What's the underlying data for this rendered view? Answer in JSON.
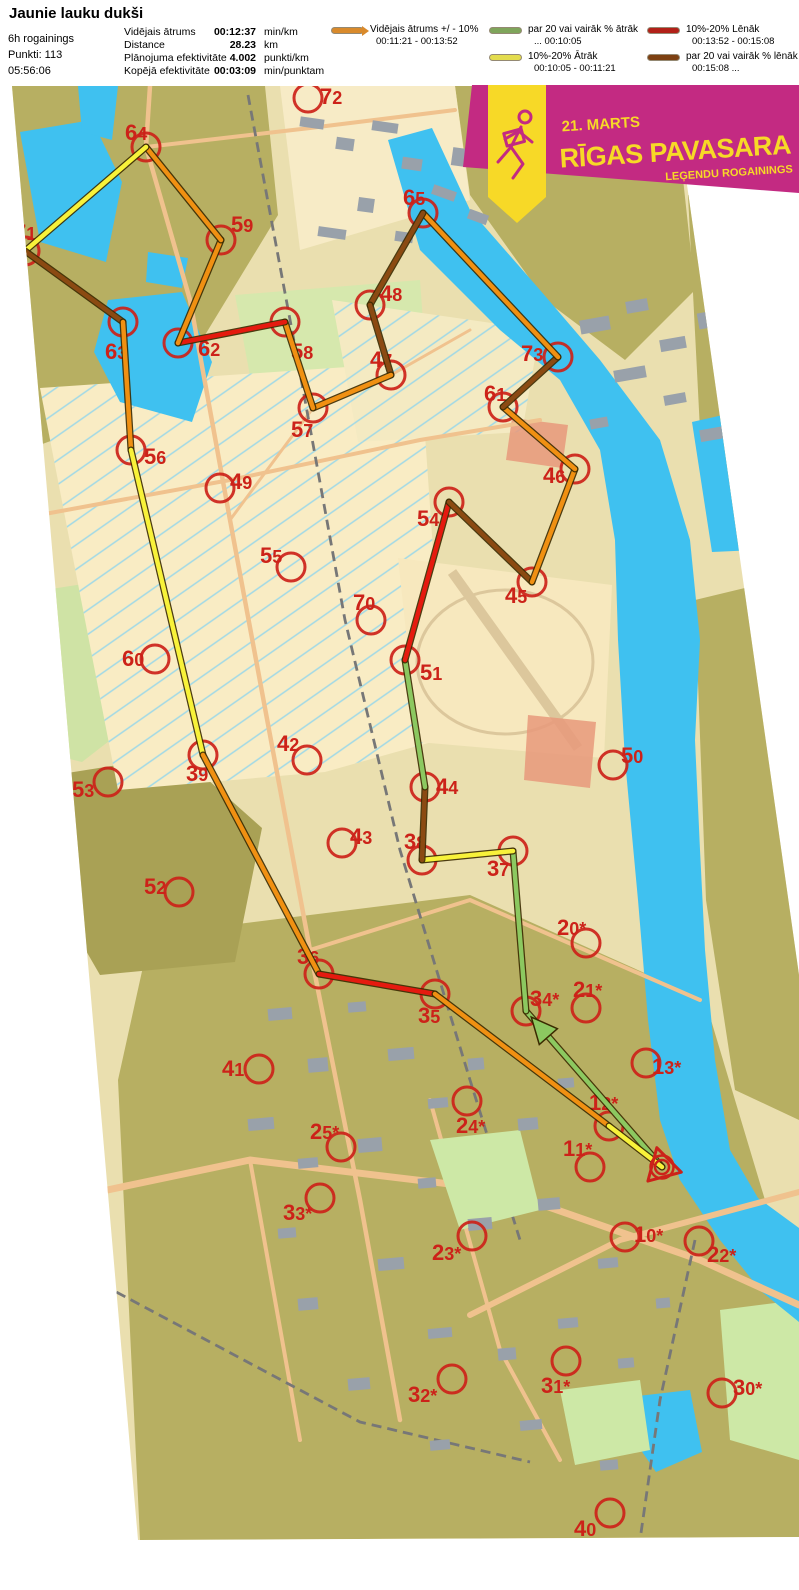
{
  "header": {
    "title": "Jaunie lauku dukši",
    "info_lines": [
      "6h rogainings",
      "Punkti: 113",
      "05:56:06"
    ],
    "stats": [
      {
        "label": "Vidējais ātrums",
        "value": "00:12:37",
        "unit": "min/km"
      },
      {
        "label": "Distance",
        "value": "28.23",
        "unit": "km"
      },
      {
        "label": "Plānojuma efektivitāte",
        "value": "4.002",
        "unit": "punkti/km"
      },
      {
        "label": "Kopējā efektivitāte",
        "value": "00:03:09",
        "unit": "min/punktam"
      }
    ],
    "legend": [
      {
        "label": "Vidējais ātrums +/ - 10%",
        "range": "00:11:21   -   00:13:52",
        "color": "#D98A2B"
      },
      {
        "label": "par 20 vai vairāk % ātrāk",
        "range": "...   00:10:05",
        "color": "#7FA55B"
      },
      {
        "label": "10%-20% Ātrāk",
        "range": "00:10:05   -   00:11:21",
        "color": "#E3DC4E"
      },
      {
        "label": "10%-20% Lēnāk",
        "range": "00:13:52   -   00:15:08",
        "color": "#B22018"
      },
      {
        "label": "par 20 vai vairāk % lēnāk",
        "range": "00:15:08   ...",
        "color": "#7D4012"
      }
    ]
  },
  "banner": {
    "date": "21. MARTS",
    "title": "RĪGAS PAVASARA",
    "subtitle": "LEĢENDU ROGAININGS",
    "bg": "#C32A82",
    "fg": "#F7D927"
  },
  "map": {
    "route_colors": {
      "avg": "#F09012",
      "fast20": "#8CC860",
      "fast10": "#F8F23A",
      "slow10": "#E51A0F",
      "slow20": "#8B4A12"
    },
    "control_color": "#CC2219",
    "start": {
      "id": "start",
      "x": 662,
      "y": 1167
    },
    "controls": [
      {
        "id": "72",
        "x": 308,
        "y": 98,
        "lx": 320,
        "ly": 86
      },
      {
        "id": "64",
        "x": 146,
        "y": 147,
        "lx": 125,
        "ly": 122
      },
      {
        "id": "71",
        "x": 25,
        "y": 251,
        "lx": 14,
        "ly": 222
      },
      {
        "id": "59",
        "x": 221,
        "y": 240,
        "lx": 231,
        "ly": 214
      },
      {
        "id": "65",
        "x": 423,
        "y": 213,
        "lx": 403,
        "ly": 187
      },
      {
        "id": "58",
        "x": 285,
        "y": 322,
        "lx": 291,
        "ly": 341
      },
      {
        "id": "48",
        "x": 370,
        "y": 305,
        "lx": 380,
        "ly": 283
      },
      {
        "id": "63",
        "x": 123,
        "y": 322,
        "lx": 105,
        "ly": 341
      },
      {
        "id": "62",
        "x": 178,
        "y": 343,
        "lx": 198,
        "ly": 338
      },
      {
        "id": "73",
        "x": 558,
        "y": 357,
        "lx": 521,
        "ly": 343
      },
      {
        "id": "47",
        "x": 391,
        "y": 375,
        "lx": 370,
        "ly": 349
      },
      {
        "id": "61",
        "x": 503,
        "y": 407,
        "lx": 484,
        "ly": 383
      },
      {
        "id": "57",
        "x": 313,
        "y": 408,
        "lx": 291,
        "ly": 419
      },
      {
        "id": "56",
        "x": 131,
        "y": 450,
        "lx": 144,
        "ly": 446
      },
      {
        "id": "46",
        "x": 575,
        "y": 469,
        "lx": 543,
        "ly": 465
      },
      {
        "id": "49",
        "x": 220,
        "y": 488,
        "lx": 230,
        "ly": 471
      },
      {
        "id": "54",
        "x": 449,
        "y": 502,
        "lx": 417,
        "ly": 508
      },
      {
        "id": "55",
        "x": 291,
        "y": 567,
        "lx": 260,
        "ly": 545
      },
      {
        "id": "45",
        "x": 532,
        "y": 582,
        "lx": 505,
        "ly": 585
      },
      {
        "id": "70",
        "x": 371,
        "y": 620,
        "lx": 353,
        "ly": 592
      },
      {
        "id": "51",
        "x": 405,
        "y": 660,
        "lx": 420,
        "ly": 662
      },
      {
        "id": "60",
        "x": 155,
        "y": 659,
        "lx": 122,
        "ly": 648
      },
      {
        "id": "39",
        "x": 203,
        "y": 755,
        "lx": 186,
        "ly": 763
      },
      {
        "id": "42",
        "x": 307,
        "y": 760,
        "lx": 277,
        "ly": 733
      },
      {
        "id": "44",
        "x": 425,
        "y": 787,
        "lx": 436,
        "ly": 776
      },
      {
        "id": "50",
        "x": 613,
        "y": 765,
        "lx": 621,
        "ly": 745
      },
      {
        "id": "53",
        "x": 108,
        "y": 782,
        "lx": 72,
        "ly": 779
      },
      {
        "id": "43",
        "x": 342,
        "y": 843,
        "lx": 350,
        "ly": 826
      },
      {
        "id": "38",
        "x": 422,
        "y": 860,
        "lx": 404,
        "ly": 831
      },
      {
        "id": "37",
        "x": 513,
        "y": 851,
        "lx": 487,
        "ly": 858
      },
      {
        "id": "52",
        "x": 179,
        "y": 892,
        "lx": 144,
        "ly": 876
      },
      {
        "id": "20*",
        "x": 586,
        "y": 943,
        "lx": 557,
        "ly": 917
      },
      {
        "id": "36",
        "x": 319,
        "y": 974,
        "lx": 297,
        "ly": 946
      },
      {
        "id": "35",
        "x": 435,
        "y": 994,
        "lx": 418,
        "ly": 1005
      },
      {
        "id": "34*",
        "x": 526,
        "y": 1011,
        "lx": 530,
        "ly": 988
      },
      {
        "id": "21*",
        "x": 586,
        "y": 1008,
        "lx": 573,
        "ly": 979
      },
      {
        "id": "13*",
        "x": 646,
        "y": 1063,
        "lx": 652,
        "ly": 1056
      },
      {
        "id": "41",
        "x": 259,
        "y": 1069,
        "lx": 222,
        "ly": 1058
      },
      {
        "id": "24*",
        "x": 467,
        "y": 1101,
        "lx": 456,
        "ly": 1115
      },
      {
        "id": "12*",
        "x": 609,
        "y": 1126,
        "lx": 589,
        "ly": 1092
      },
      {
        "id": "25*",
        "x": 341,
        "y": 1147,
        "lx": 310,
        "ly": 1121
      },
      {
        "id": "11*",
        "x": 590,
        "y": 1167,
        "lx": 563,
        "ly": 1138
      },
      {
        "id": "33*",
        "x": 320,
        "y": 1198,
        "lx": 283,
        "ly": 1202
      },
      {
        "id": "23*",
        "x": 472,
        "y": 1236,
        "lx": 432,
        "ly": 1242
      },
      {
        "id": "10*",
        "x": 625,
        "y": 1237,
        "lx": 634,
        "ly": 1224
      },
      {
        "id": "22*",
        "x": 699,
        "y": 1241,
        "lx": 707,
        "ly": 1244
      },
      {
        "id": "31*",
        "x": 566,
        "y": 1361,
        "lx": 541,
        "ly": 1375
      },
      {
        "id": "32*",
        "x": 452,
        "y": 1379,
        "lx": 408,
        "ly": 1384
      },
      {
        "id": "30*",
        "x": 722,
        "y": 1393,
        "lx": 733,
        "ly": 1377
      },
      {
        "id": "40",
        "x": 610,
        "y": 1513,
        "lx": 574,
        "ly": 1518
      }
    ],
    "legs": [
      {
        "from": "start",
        "to": "34*",
        "speed": "fast20",
        "arrow": true
      },
      {
        "from": "34*",
        "to": "37",
        "speed": "fast20"
      },
      {
        "from": "37",
        "to": "38",
        "speed": "fast10"
      },
      {
        "from": "38",
        "to": "44",
        "speed": "slow20"
      },
      {
        "from": "44",
        "to": "51",
        "speed": "fast20"
      },
      {
        "from": "51",
        "to": "54",
        "speed": "slow10"
      },
      {
        "from": "54",
        "to": "45",
        "speed": "slow20"
      },
      {
        "from": "45",
        "to": "46",
        "speed": "avg"
      },
      {
        "from": "46",
        "to": "61",
        "speed": "avg"
      },
      {
        "from": "61",
        "to": "73",
        "speed": "slow20"
      },
      {
        "from": "73",
        "to": "65",
        "speed": "avg"
      },
      {
        "from": "65",
        "to": "48",
        "speed": "slow20"
      },
      {
        "from": "48",
        "to": "47",
        "speed": "slow20"
      },
      {
        "from": "47",
        "to": "57",
        "speed": "avg"
      },
      {
        "from": "57",
        "to": "58",
        "speed": "avg"
      },
      {
        "from": "58",
        "to": "62",
        "speed": "slow10"
      },
      {
        "from": "62",
        "to": "59",
        "speed": "avg"
      },
      {
        "from": "59",
        "to": "64",
        "speed": "avg"
      },
      {
        "from": "64",
        "to": "71",
        "speed": "fast10"
      },
      {
        "from": "71",
        "to": "63",
        "speed": "slow20"
      },
      {
        "from": "63",
        "to": "56",
        "speed": "avg"
      },
      {
        "from": "56",
        "to": "39",
        "speed": "fast10"
      },
      {
        "from": "39",
        "to": "36",
        "speed": "avg"
      },
      {
        "from": "36",
        "to": "35",
        "speed": "slow10"
      },
      {
        "from": "35",
        "to": "12*",
        "speed": "avg"
      },
      {
        "from": "12*",
        "to": "start",
        "speed": "fast10"
      }
    ]
  }
}
